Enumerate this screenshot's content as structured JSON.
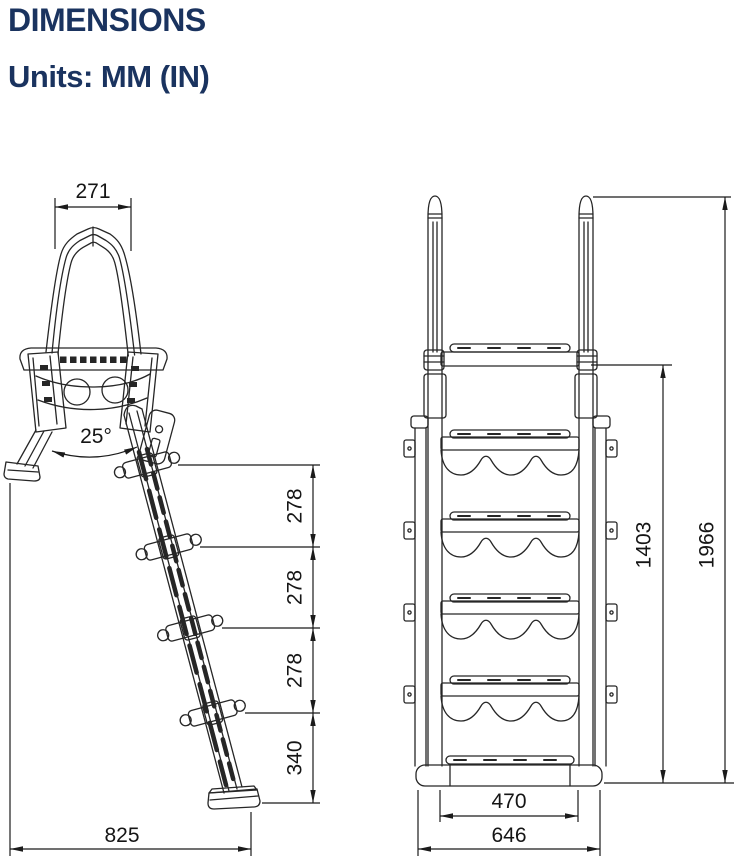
{
  "header": {
    "title": "DIMENSIONS",
    "units": "Units: MM (IN)"
  },
  "colors": {
    "title_text": "#1a335f",
    "drawing_lines": "#262626",
    "background": "#ffffff"
  },
  "side_view": {
    "dims": {
      "handle_top_width": "271",
      "ladder_angle": "25°",
      "step_spacing_1": "278",
      "step_spacing_2": "278",
      "step_spacing_3": "278",
      "bottom_section": "340",
      "footprint_depth": "825"
    }
  },
  "front_view": {
    "dims": {
      "platform_height": "1403",
      "total_height": "1966",
      "step_inner_width": "470",
      "base_outer_width": "646"
    }
  }
}
